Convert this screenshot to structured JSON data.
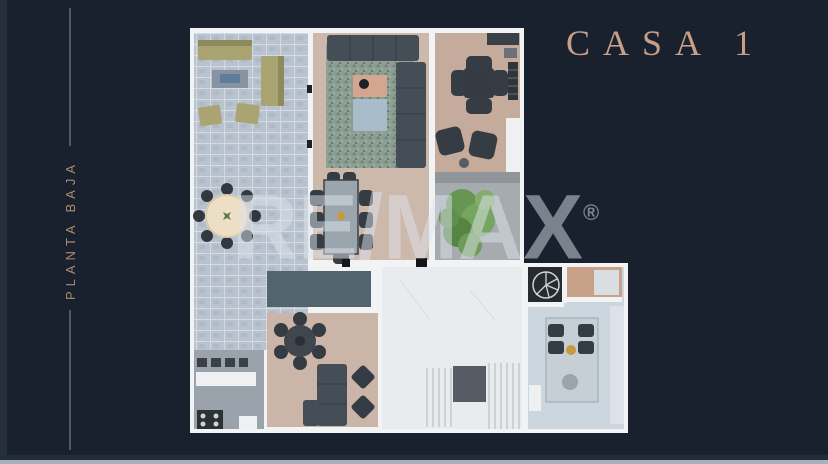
{
  "page": {
    "background": "#19212f",
    "bottom_strip_color": "#a6b0be"
  },
  "sidebar": {
    "label": "PLANTA BAJA",
    "color": "#ab8d6e",
    "rule_color": "#4e5a66"
  },
  "title": {
    "text": "CASA 1",
    "color": "#c89e86"
  },
  "watermark": {
    "re": "RE",
    "slash": "/",
    "max": "MAX",
    "registered": "®",
    "color": "rgba(222,228,235,0.5)"
  },
  "floorplan": {
    "colors": {
      "wall": "#f2f3f5",
      "terrace_stone": "#b9c3cf",
      "outdoor_kitchen": "#9aa2ab",
      "living_floor": "#cdb9ac",
      "dining_floor": "#c4ab9b",
      "courtyard": "#a6abb0",
      "pool_slab": "#53646e",
      "family_floor": "#cbb5a8",
      "hallway_marble": "#e9ecee",
      "kitchen_floor": "#ccd6de",
      "rug": "#8d9e92",
      "plant": "#679552",
      "gold_pendant": "#c79a3c",
      "accent_table": "#d4a58f",
      "stair_landing": "#565c63",
      "wood_closet": "#c8a288"
    }
  }
}
